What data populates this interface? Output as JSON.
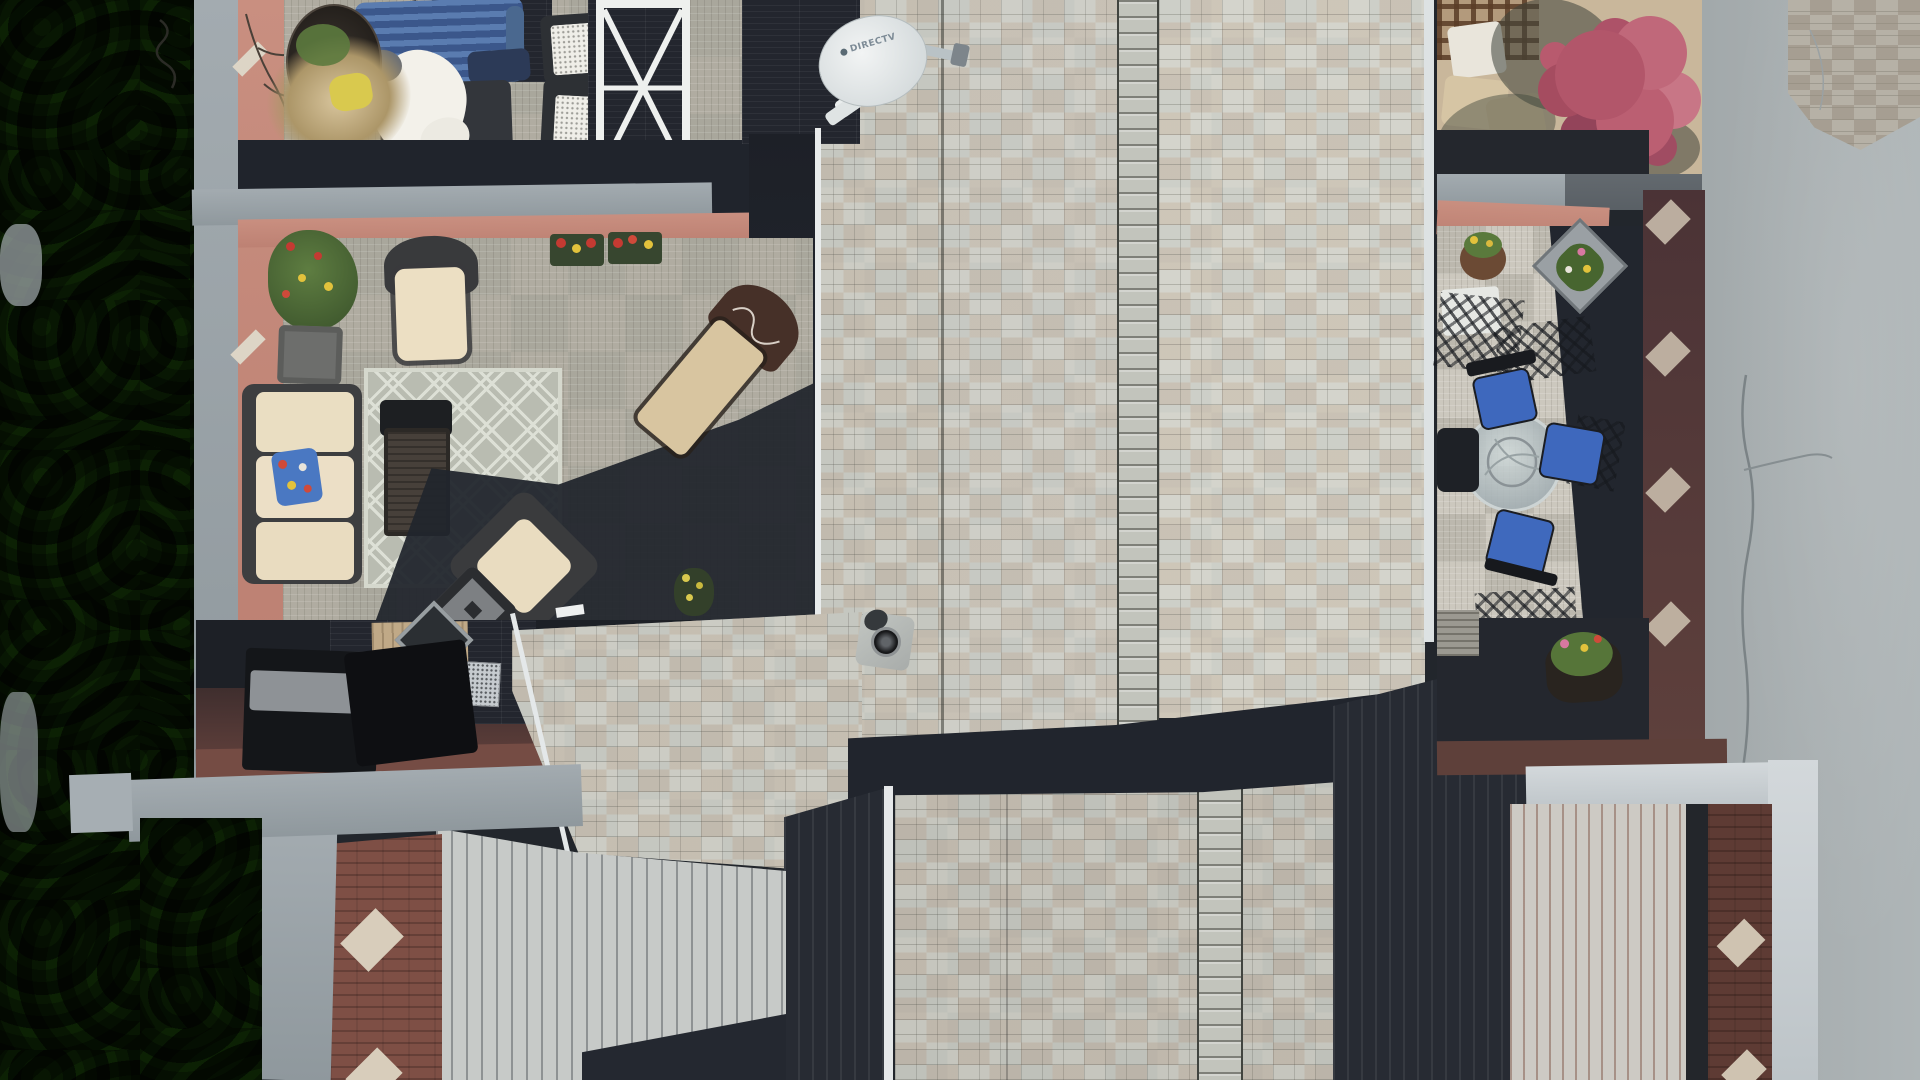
{
  "scene": {
    "type": "aerial-drone-photo",
    "viewpoint": "top-down nadir view",
    "subject": "Townhouse rooftop decks and furnished patios beside a row of conifer trees and an asphalt lane",
    "lighting": "hard afternoon sunlight casting long navy shadows",
    "objects": [
      {
        "name": "conifer-trees",
        "desc": "dense green conifer hedge along the entire left edge"
      },
      {
        "name": "asphalt-road",
        "desc": "gray asphalt lane with a wavy surface crack on the right side"
      },
      {
        "name": "stone-paver-corner",
        "desc": "mottled stone pavers at the top-right corner"
      },
      {
        "name": "directv-dish",
        "desc": "white DIRECTV satellite dish mounted at the roof edge"
      },
      {
        "name": "shingle-roof",
        "desc": "gray-tan architectural shingle roof planes with ridge-cap columns and valley seams"
      },
      {
        "name": "roof-vent",
        "desc": "round black vent pipe with gray flashing"
      },
      {
        "name": "upper-deck",
        "desc": "rooftop deck with blue slat bench, white robe over a chair, black mesh chairs, white X-frame table, dried-grass planter"
      },
      {
        "name": "lower-patio",
        "desc": "deck-tile patio with cream wicker sofa, diamond lattice rug, dark coffee table, wicker chairs and ottoman"
      },
      {
        "name": "floral-pillow",
        "desc": "blue floral accent pillow on the cream sofa"
      },
      {
        "name": "flower-boxes",
        "desc": "window boxes and planters with red and yellow blooms"
      },
      {
        "name": "chaise-lounge",
        "desc": "chaise with tan cushion and dark brown monogrammed hood"
      },
      {
        "name": "storage-boxes",
        "desc": "black deck storage boxes on the shaded lower terrace"
      },
      {
        "name": "skylight",
        "desc": "diamond-set skylight with metal frame"
      },
      {
        "name": "ac-grille",
        "desc": "silver grille unit on the lower terrace"
      },
      {
        "name": "right-patio",
        "desc": "patio with round glass table and four blue-cushion metal chairs"
      },
      {
        "name": "hanging-basket",
        "desc": "hanging flower basket at the patio corner"
      },
      {
        "name": "corner-planter",
        "desc": "diamond-set gray planter with pink and yellow flowers"
      },
      {
        "name": "maple-tree",
        "desc": "crimson Japanese maple over the top-right recessed patio"
      },
      {
        "name": "parapet-caps",
        "desc": "light gray parapet wall caps framing each roof section"
      },
      {
        "name": "salmon-walls",
        "desc": "salmon-pink parapet faces with small white diamond ornaments"
      },
      {
        "name": "maroon-walls",
        "desc": "dark maroon parapet faces with pale diamond ornaments"
      },
      {
        "name": "standing-seam-roofs",
        "desc": "pale vertical standing-seam metal roof planes, partly in shadow"
      },
      {
        "name": "potted-plants",
        "desc": "small potted plants with yellow and pink flowers on shaded decks"
      }
    ]
  },
  "satellite_dish": {
    "brand_label": "DIRECTV"
  },
  "palette": {
    "asphalt": "#aab1b3",
    "tree_green": "#3c5730",
    "tree_light": "#76a24c",
    "shingle": "#c5c7c0",
    "shingle_tan": "#c0b2a0",
    "seam_light": "#c7cac8",
    "shadow_navy": "#21252d",
    "parapet_gray": "#9aa3a8",
    "parapet_bright": "#ccd2d5",
    "salmon": "#c4887a",
    "maroon": "#54393c",
    "brick_red": "#7e4f45",
    "deck_light": "#b2aea4",
    "deck_dark": "#23262e",
    "bench_blue": "#3b578b",
    "cushion_cream": "#ebdec3",
    "chair_blue": "#3e68bd",
    "maple_red": "#b2566a",
    "flower_red": "#c43a32",
    "flower_yellow": "#e2c23c",
    "robe_white": "#f3f1ea"
  }
}
